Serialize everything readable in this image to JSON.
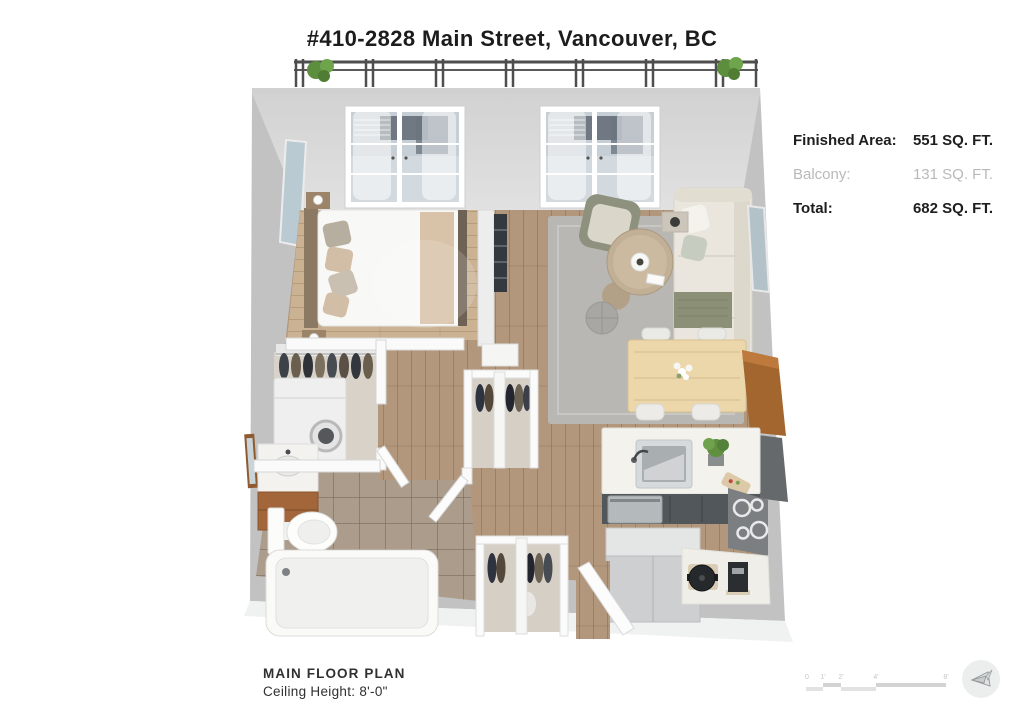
{
  "title": "#410-2828 Main Street, Vancouver, BC",
  "stats": {
    "rows": [
      {
        "label": "Finished Area:",
        "value": "551 SQ. FT.",
        "style": "bold"
      },
      {
        "label": "Balcony:",
        "value": "131 SQ. FT.",
        "style": "muted"
      },
      {
        "label": "Total:",
        "value": "682 SQ. FT.",
        "style": "bold"
      }
    ]
  },
  "footer": {
    "plan_name": "MAIN FLOOR PLAN",
    "ceiling_height": "Ceiling Height: 8'-0\""
  },
  "scale_bar": {
    "labels": [
      "0",
      "1'",
      "2'",
      "4'",
      "8'"
    ]
  },
  "colors": {
    "text_dark": "#1e1e1e",
    "text_muted": "#b9b9b9",
    "wall_gray": "#c2c2c2",
    "back_wall": "#d9d9d9",
    "living_floor_wood": "#b3977c",
    "bedroom_floor_wood": "#cab293",
    "bathroom_tile": "#ab9c8c",
    "rug_gray": "#b8b7b3",
    "sofa_cream": "#eae6dd",
    "armchair_olive": "#8d917d",
    "kitchen_cabinet_dark": "#52575b",
    "wood_bar_accent": "#a4662f",
    "plant_green": "#5c8e3e",
    "railing_metal": "#4e4e4e"
  }
}
